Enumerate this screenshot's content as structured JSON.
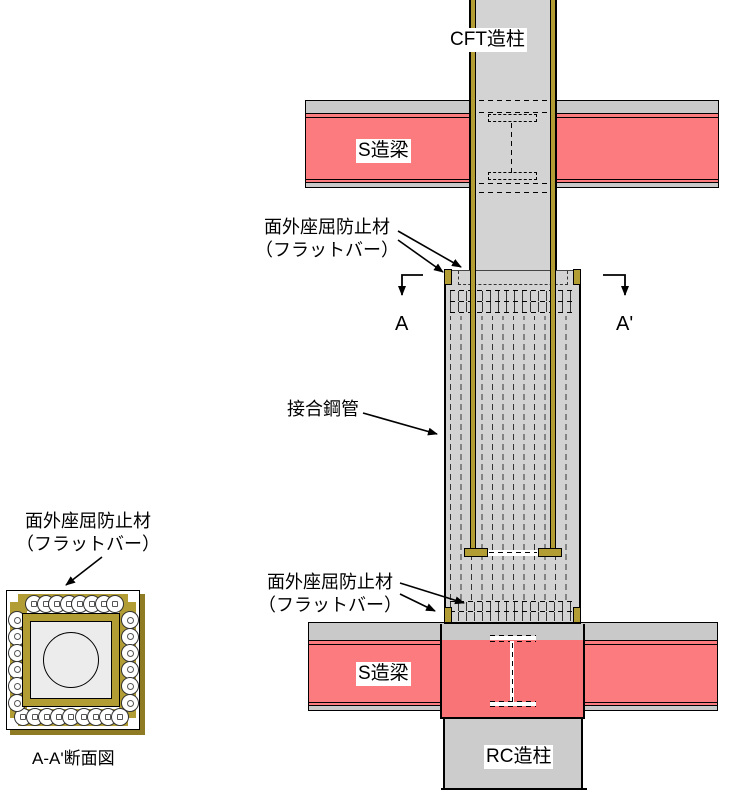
{
  "labels": {
    "cft_column": "CFT造柱",
    "s_beam": "S造梁",
    "rc_column": "RC造柱",
    "joint_pipe": "接合鋼管",
    "flatbar_line1": "面外座屈防止材",
    "flatbar_line2": "（フラットバー）",
    "marker_a": "A",
    "marker_a_prime": "A'",
    "section_title": "A-A'断面図"
  },
  "colors": {
    "beam_pink": "#FC7B7F",
    "panel_pink": "#F87476",
    "slab_gray": "#C9C9C9",
    "column_gray": "#D3D3D3",
    "rc_gray": "#CCCCCC",
    "steel_olive": "#B19D33",
    "shadow_olive": "#8E7B24",
    "section_fill": "#ECECEC",
    "dash_dark": "#333333"
  }
}
